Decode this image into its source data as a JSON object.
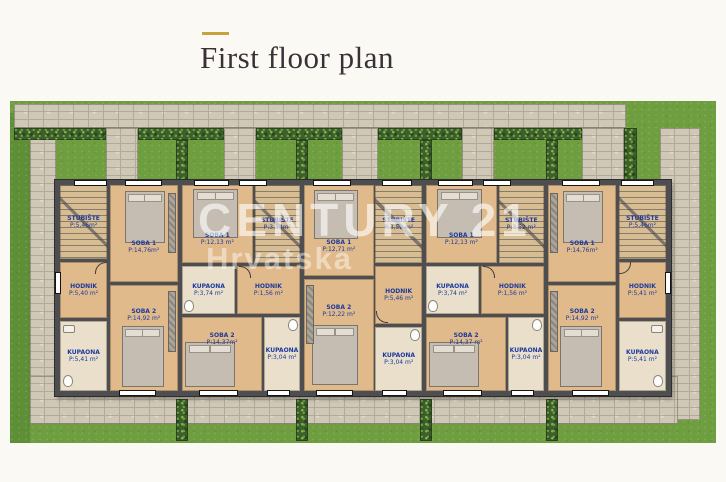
{
  "page": {
    "title": "First floor plan",
    "background_color": "#fbf9f4",
    "accent_color": "#c7a23e",
    "title_color": "#3a3138"
  },
  "watermark": {
    "line1": "CENTURY 21",
    "line2": "Hrvatska"
  },
  "plan": {
    "type": "architectural-floor-plan",
    "label_color": "#1d3a9e",
    "grass_color": "#6f9e40",
    "stone_color": "#cfc8b7",
    "hedge_color": "#3c5f2c",
    "wall_color": "#4e4e50",
    "floor_color": "#e0ba8a",
    "units": {
      "u1": {
        "stubiste": {
          "name": "STUBIŠTE",
          "area": "P:5,46m²"
        },
        "soba1": {
          "name": "SOBA 1",
          "area": "P:14,76m²"
        },
        "hodnik": {
          "name": "HODNIK",
          "area": "P:5,40 m²"
        },
        "soba2": {
          "name": "SOBA 2",
          "area": "P:14,92 m²"
        },
        "kupaona": {
          "name": "KUPAONA",
          "area": "P:5,41 m²"
        }
      },
      "u2": {
        "soba1": {
          "name": "SOBA 1",
          "area": "P:12,13 m²"
        },
        "stubiste": {
          "name": "STUBIŠTE",
          "area": "P:3,53m²"
        },
        "kupaona1": {
          "name": "KUPAONA",
          "area": "P:3,74 m²"
        },
        "hodnik": {
          "name": "HODNIK",
          "area": "P:1,56 m²"
        },
        "soba2": {
          "name": "SOBA 2",
          "area": "P:14,37m²"
        },
        "kupaona2": {
          "name": "KUPAONA",
          "area": "P:3,04 m²"
        }
      },
      "u3": {
        "soba1": {
          "name": "SOBA 1",
          "area": "P:12,71 m²"
        },
        "stubiste": {
          "name": "STUBIŠTE",
          "area": "P:3,52 m²"
        },
        "hodnik": {
          "name": "HODNIK",
          "area": "P:5,46 m²"
        },
        "soba2": {
          "name": "SOBA 2",
          "area": "P:12,22 m²"
        },
        "kupaona": {
          "name": "KUPAONA",
          "area": "P:3,04 m²"
        }
      },
      "u4": {
        "soba1": {
          "name": "SOBA 1",
          "area": "P:12,13 m²"
        },
        "stubiste": {
          "name": "STUBIŠTE",
          "area": "P:3,52 m²"
        },
        "kupaona1": {
          "name": "KUPAONA",
          "area": "P:3,74 m²"
        },
        "hodnik": {
          "name": "HODNIK",
          "area": "P:1,56 m²"
        },
        "soba2": {
          "name": "SOBA 2",
          "area": "P:14,37 m²"
        },
        "kupaona2": {
          "name": "KUPAONA",
          "area": "P:3,04 m²"
        }
      },
      "u5": {
        "soba1": {
          "name": "SOBA 1",
          "area": "P:14,76m²"
        },
        "stubiste": {
          "name": "STUBIŠTE",
          "area": "P:5,46m²"
        },
        "hodnik": {
          "name": "HODNIK",
          "area": "P:5,41 m²"
        },
        "soba2": {
          "name": "SOBA 2",
          "area": "P:14,92 m²"
        },
        "kupaona": {
          "name": "KUPAONA",
          "area": "P:5,41 m²"
        }
      }
    }
  }
}
